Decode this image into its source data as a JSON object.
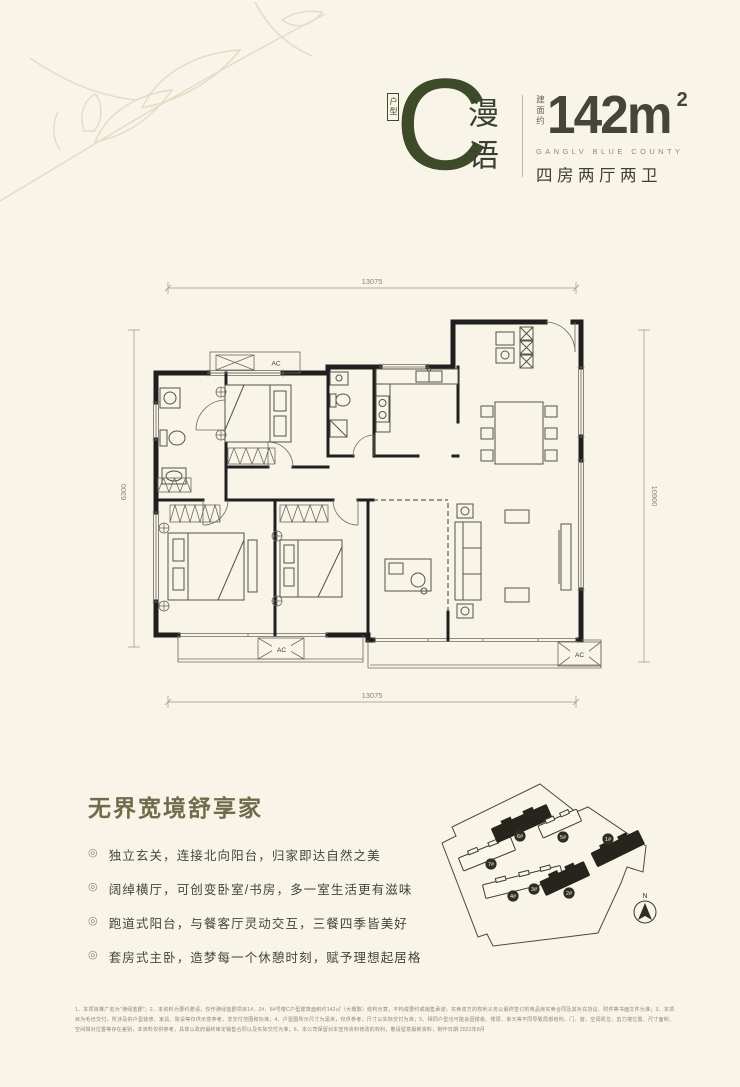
{
  "header": {
    "type_label": "户型",
    "type_letter": "C",
    "type_name": "漫语",
    "area_prefix": "建面约",
    "area_value": "142m",
    "area_sup": "2",
    "project_en": "GANGLV BLUE COUNTY",
    "layout": "四房两厅两卫",
    "accent_color": "#3d4b29"
  },
  "floorplan": {
    "dim_top": "13075",
    "dim_bottom": "13075",
    "dim_left": "6300",
    "dim_right": "10900",
    "ac_label": "AC",
    "wall_color": "#1f1f1f"
  },
  "features": {
    "title": "无界宽境舒享家",
    "bullet_icon": "◎",
    "items": [
      "独立玄关，连接北向阳台，归家即达自然之美",
      "阔绰横厅，可创变卧室/书房，多一室生活更有滋味",
      "跑道式阳台，与餐客厅灵动交互，三餐四季皆美好",
      "套房式主卧，造梦每一个休憩时刻，赋予理想起居格"
    ]
  },
  "siteplan": {
    "north_label": "N",
    "buildings": [
      {
        "label": "1#",
        "highlighted": true
      },
      {
        "label": "2#",
        "highlighted": true
      },
      {
        "label": "3#",
        "highlighted": false
      },
      {
        "label": "4#",
        "highlighted": false
      },
      {
        "label": "5#",
        "highlighted": false
      },
      {
        "label": "6#",
        "highlighted": true
      },
      {
        "label": "7#",
        "highlighted": false
      }
    ]
  },
  "disclaimer": {
    "text": "1、本项目推广名为“港绿蓝郡”；2、本资料为要约邀请，仅作港绿蓝郡项目1#、2#、6#号楼C户型建筑面积约142㎡（大概数）结构示意，不构成要约或销售承诺，买卖双方的权利义务以最终签订的商品房买卖合同及其补充协议、附件等书面文件为准；3、本项目为毛坯交付，所涉及的户型装修、家具、陈设等仅供示意参考，非交付范围和标准；4、户型图所示尺寸为毫米，仅供参考，尺寸以实际交付为准；5、相同户型也可能会因楼栋、楼层、单元等不同导致局部结构、门、窗、空调机位、剪力墙位置、尺寸面积、空间相对位置等存在差别，本资料仅供参考，具体以政府最终审定销售合同以及实际交付为准；6、本公司保留对本宣传资料修改的权利，敬请留意最新资料，制作日期:2022年8月"
  }
}
